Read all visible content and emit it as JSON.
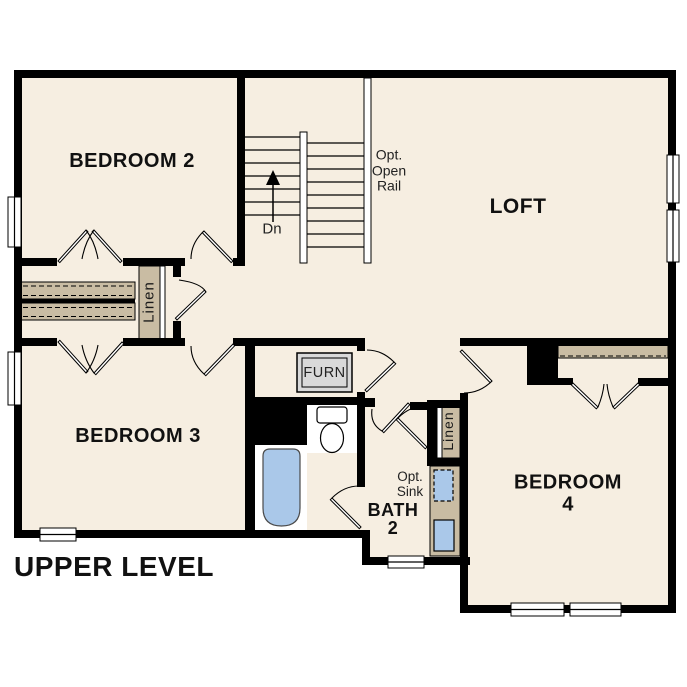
{
  "plan": {
    "title": "UPPER LEVEL",
    "rooms": {
      "bedroom2": "BEDROOM 2",
      "bedroom3": "BEDROOM 3",
      "bedroom4": "BEDROOM 4",
      "loft": "LOFT",
      "bath2": "BATH\n2"
    },
    "annotations": {
      "opt_open_rail": "Opt.\nOpen\nRail",
      "stairs_down": "Dn",
      "linen_left": "Linen",
      "linen_right": "Linen",
      "furnace": "FURN",
      "opt_sink": "Opt.\nSink"
    },
    "colors": {
      "background": "#ffffff",
      "floor": "#f6eee1",
      "wall": "#000000",
      "shelf": "#c9bca3",
      "fixture_blue": "#aac8e9",
      "furnace_fill": "#d9d9d9"
    }
  }
}
